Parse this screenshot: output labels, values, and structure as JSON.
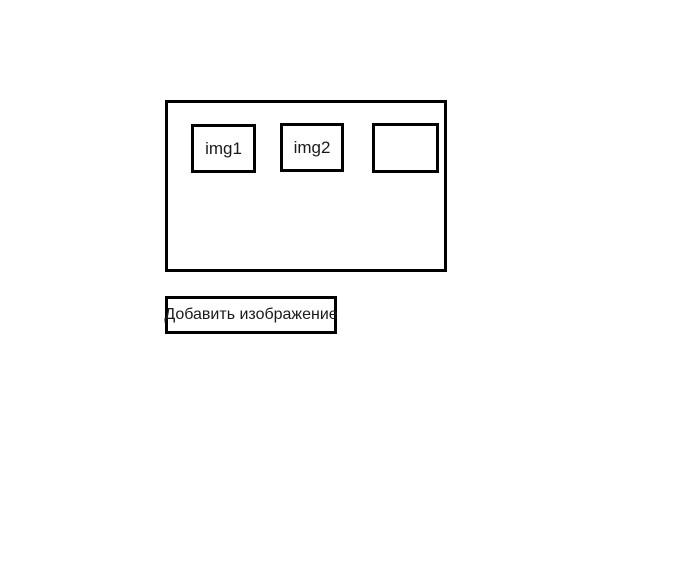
{
  "window": {
    "background": "#ffffff"
  },
  "colors": {
    "border": "#000000",
    "text": "#1a1a1a",
    "background": "#ffffff"
  },
  "gallery": {
    "images": [
      {
        "label": "img1"
      },
      {
        "label": "img2"
      },
      {
        "label": ""
      }
    ]
  },
  "controls": {
    "add_image_label": "Добавить изображение"
  }
}
